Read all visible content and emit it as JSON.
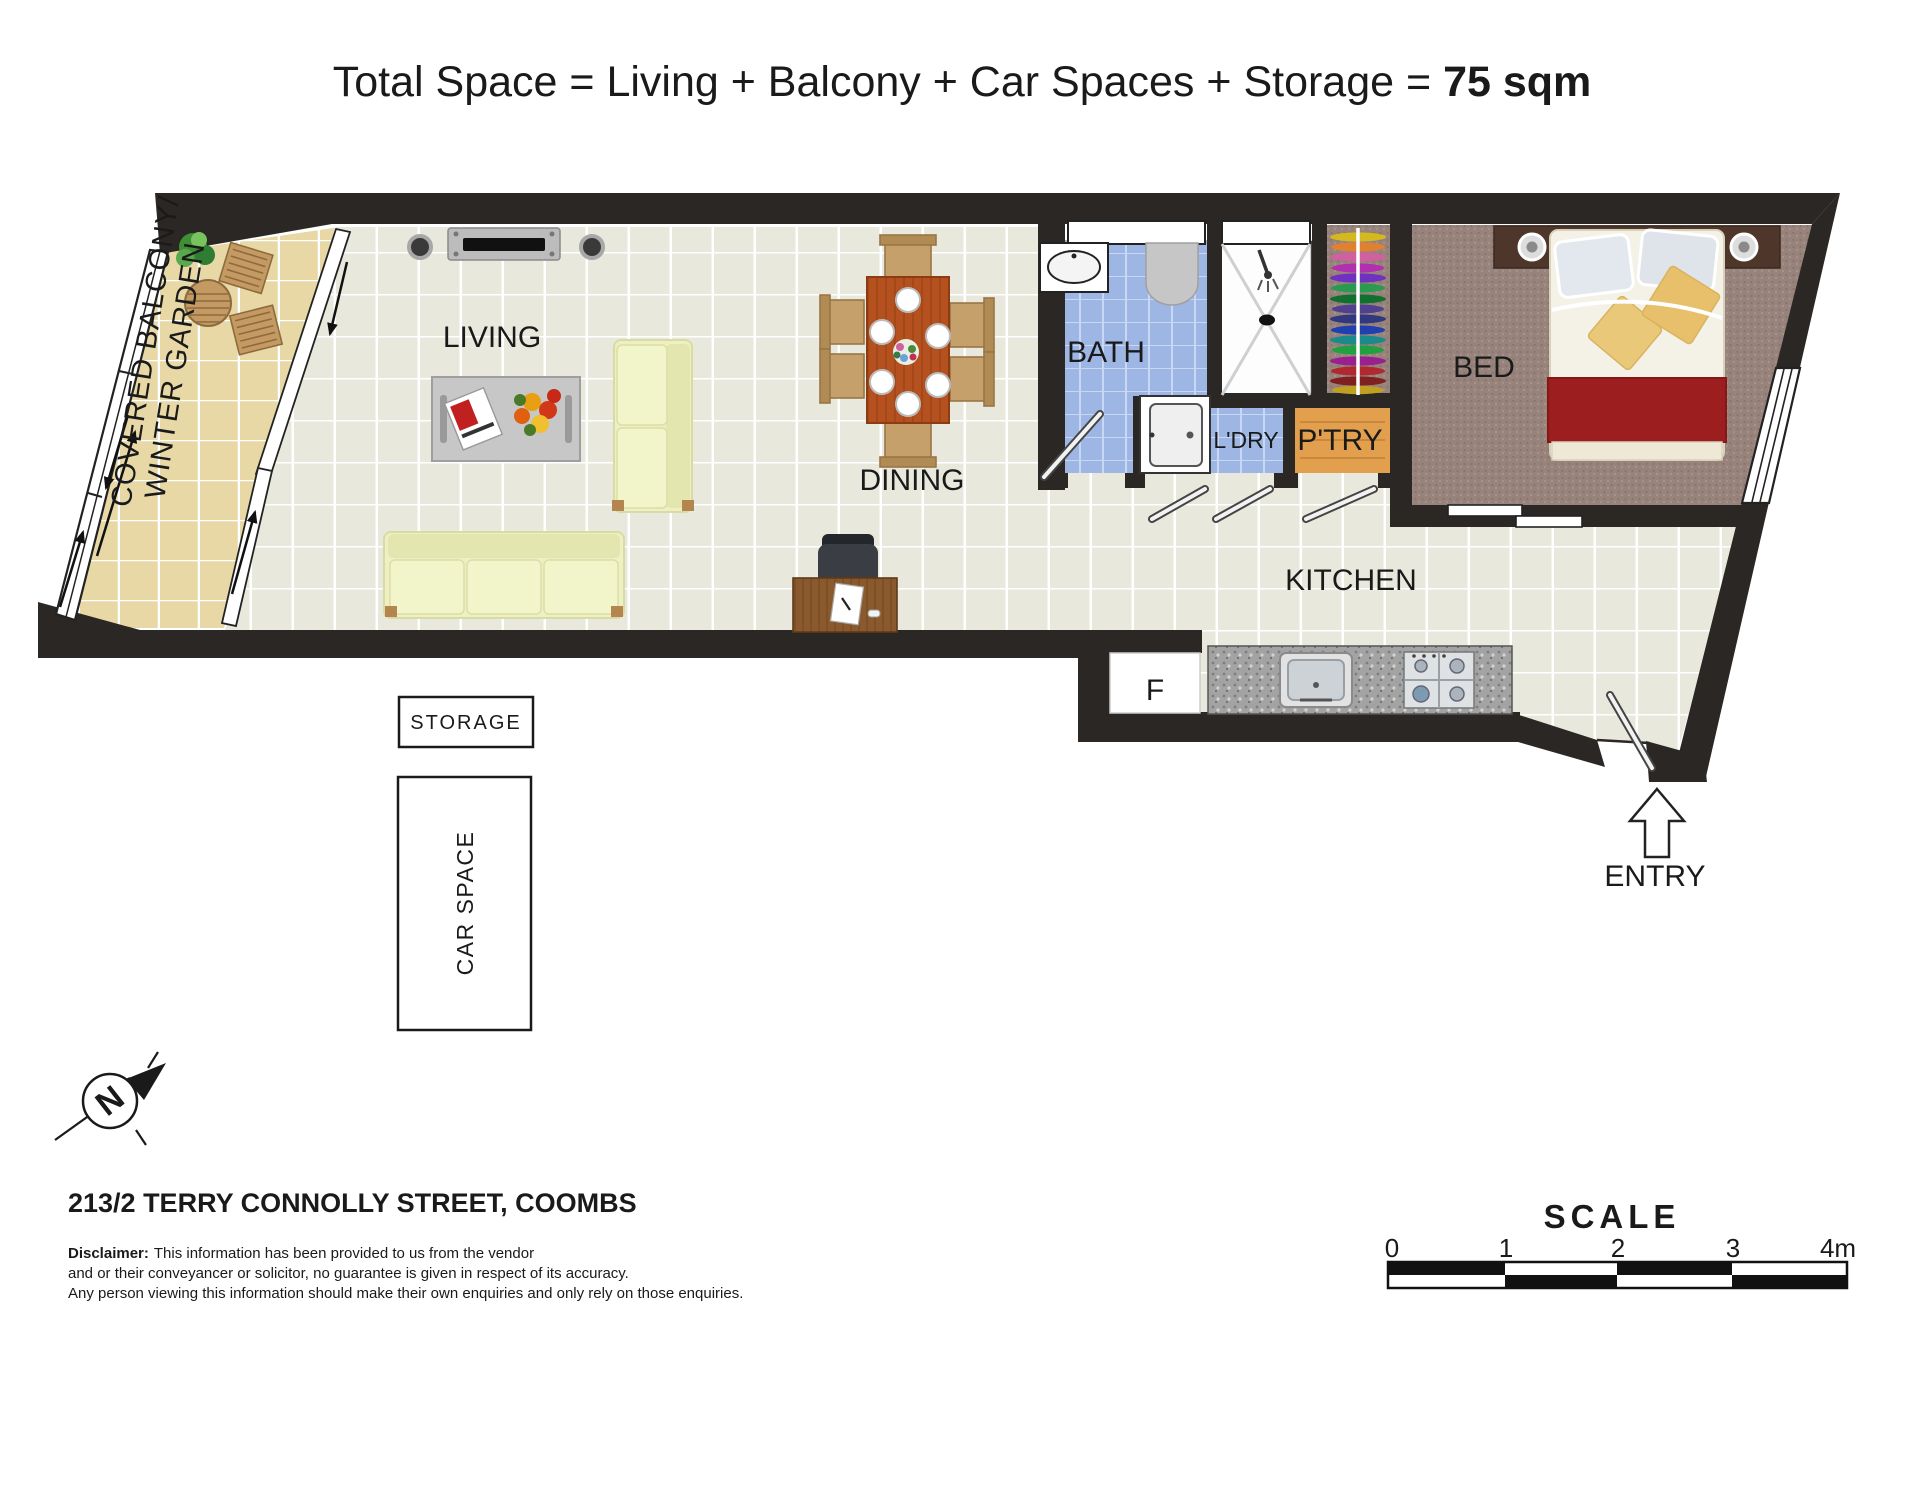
{
  "title": {
    "prefix": "Total Space = Living + Balcony + Car Spaces + Storage = ",
    "total": "75 sqm"
  },
  "rooms": {
    "balcony_line1": "COVERED BALCONY/",
    "balcony_line2": "WINTER GARDEN",
    "living": "LIVING",
    "dining": "DINING",
    "bath": "BATH",
    "laundry": "L'DRY",
    "pantry": "P'TRY",
    "bed": "BED",
    "kitchen": "KITCHEN",
    "fridge": "F",
    "entry": "ENTRY"
  },
  "outbuildings": {
    "storage": "STORAGE",
    "car_space": "CAR SPACE"
  },
  "compass": {
    "north": "N"
  },
  "footer": {
    "address": "213/2 TERRY CONNOLLY STREET, COOMBS",
    "disclaimer_label": "Disclaimer:",
    "disclaimer_line1": "This information has been provided to us from the vendor",
    "disclaimer_line2": "and or their conveyancer or solicitor, no guarantee is given in respect of its accuracy.",
    "disclaimer_line3": "Any person viewing this information should make their own enquiries and only rely on those enquiries."
  },
  "scale_bar": {
    "title": "SCALE",
    "ticks": [
      "0",
      "1",
      "2",
      "3",
      "4m"
    ]
  },
  "colors": {
    "wall": "#2b2724",
    "floor_tile": "#e8e9dc",
    "balcony": "#e7d8a6",
    "bath_tile": "#9db6e4",
    "carpet": "#97837b",
    "pantry": "#e2a04e",
    "counter": "#a3a3a3",
    "sofa": "#eef0c3",
    "dining_wood": "#b5511f",
    "blanket_red": "#9c1e1e"
  }
}
